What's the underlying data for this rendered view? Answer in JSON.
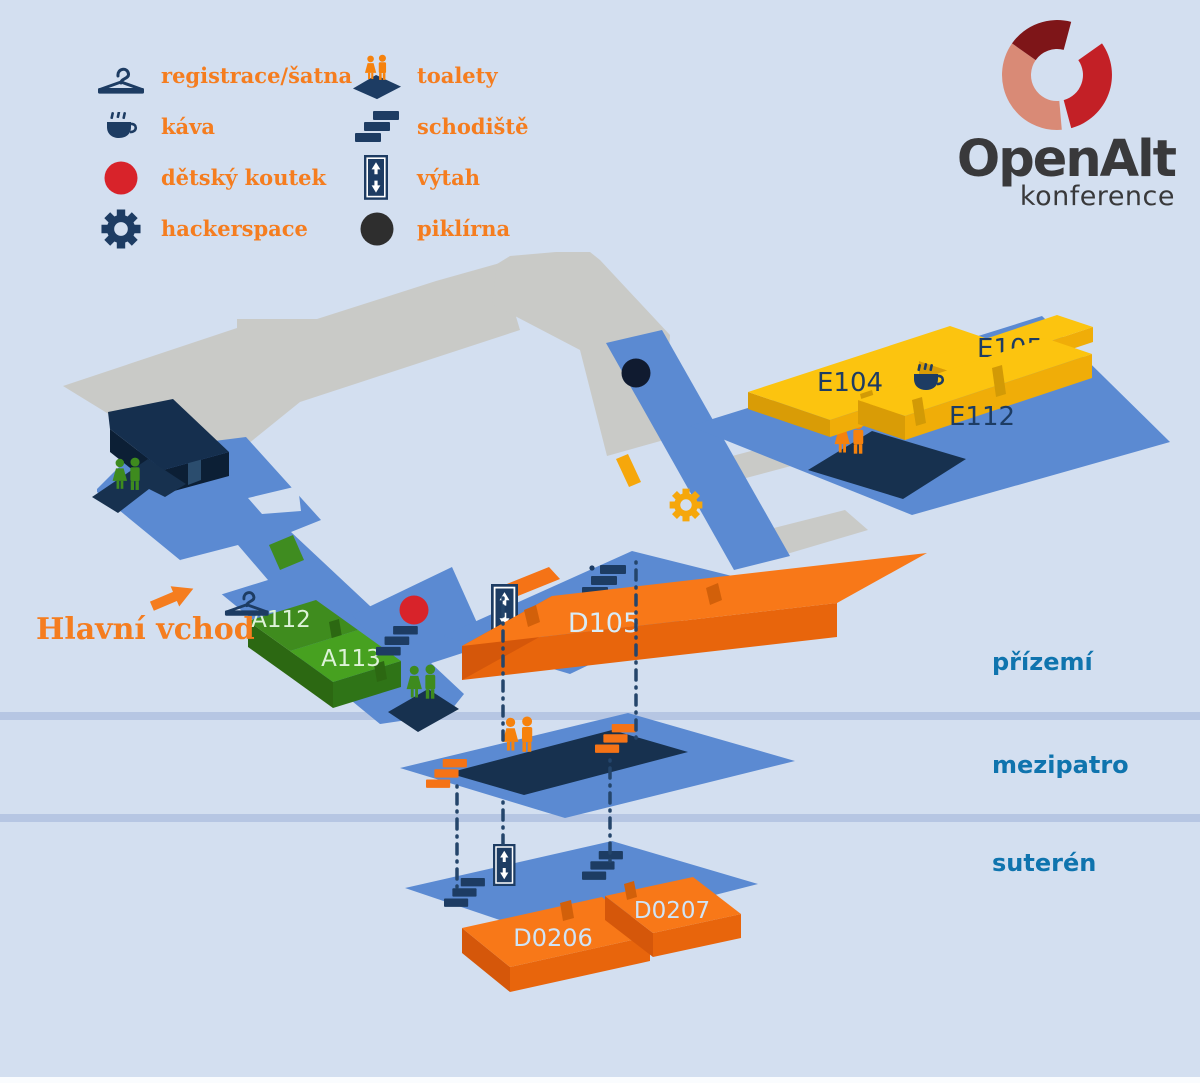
{
  "legend": {
    "col1": [
      {
        "icon": "hanger-icon",
        "label": "registrace/šatna"
      },
      {
        "icon": "coffee-icon",
        "label": "káva"
      },
      {
        "icon": "kids-corner-dot-icon",
        "label": "dětský koutek"
      },
      {
        "icon": "gear-icon",
        "label": "hackerspace"
      }
    ],
    "col2": [
      {
        "icon": "toilets-icon",
        "label": "toalety"
      },
      {
        "icon": "stairs-icon",
        "label": "schodiště"
      },
      {
        "icon": "elevator-icon",
        "label": "výtah"
      },
      {
        "icon": "dark-dot-icon",
        "label": "piklírna"
      }
    ]
  },
  "logo": {
    "title": "OpenAlt",
    "subtitle": "konference"
  },
  "map": {
    "entrance_label": "Hlavní vchod",
    "rooms": {
      "e104": "E104",
      "e105": "E105",
      "e112": "E112",
      "a112": "A112",
      "a113": "A113",
      "d105": "D105",
      "d0206": "D0206",
      "d0207": "D0207"
    }
  },
  "floors": {
    "ground": "přízemí",
    "mezzanine": "mezipatro",
    "basement": "suterén"
  },
  "colors": {
    "background": "#d3dff0",
    "divider": "#b6c6e3",
    "floor_blue": "#5b8ad2",
    "floor_gray": "#c9cac7",
    "navy": "#1d3c63",
    "orange_accent": "#f57d1f",
    "room_yellow": "#fcc40f",
    "room_orange": "#f87818",
    "room_green": "#3f8c1e",
    "red": "#d8232a",
    "floor_label_blue": "#0f74ae",
    "logo_dark_red": "#7e1518",
    "logo_red": "#c32026",
    "logo_salmon": "#d98a76"
  }
}
